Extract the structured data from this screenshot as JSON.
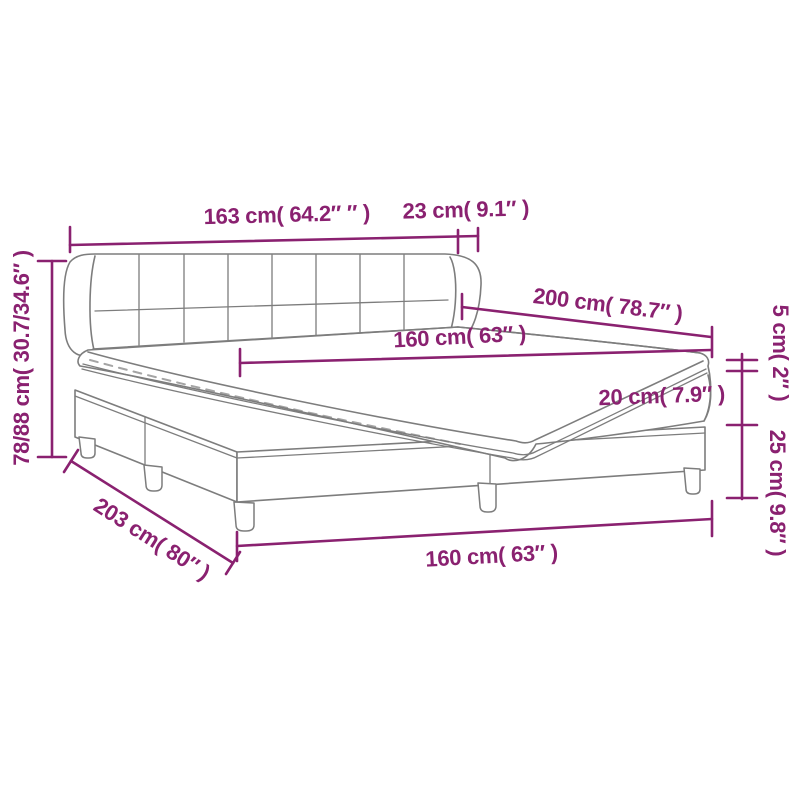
{
  "diagram": {
    "subject": "bed dimension diagram",
    "colors": {
      "dimension_accent": "#8A2170",
      "bed_outline": "#7d7d7d",
      "background": "#ffffff"
    },
    "labels": {
      "headboard_width": "163 cm( 64.2″ ″ )",
      "headboard_side": "23 cm( 9.1″ )",
      "bed_length": "200 cm( 78.7″ )",
      "mattress_width": "160 cm( 63″ )",
      "topper_height": "5 cm( 2″ )",
      "mattress_height": "20 cm( 7.9″ )",
      "base_height": "25 cm( 9.8″ )",
      "total_height": "78/88 cm( 30.7/34.6″ )",
      "base_length": "203 cm( 80″ )",
      "base_width_bottom": "160 cm( 63″ )"
    }
  }
}
